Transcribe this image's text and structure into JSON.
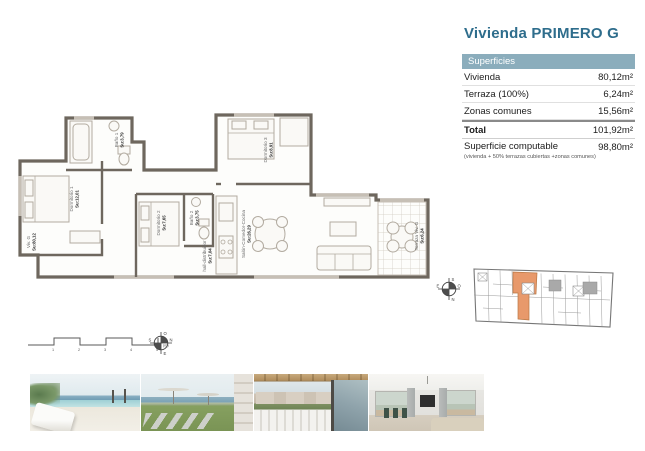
{
  "title": "Vivienda PRIMERO G",
  "surfaces": {
    "header": "Superficies",
    "rows": [
      {
        "label": "Vivienda",
        "value": "80,12m²"
      },
      {
        "label": "Terraza (100%)",
        "value": "6,24m²"
      },
      {
        "label": "Zonas comunes",
        "value": "15,56m²"
      }
    ],
    "total_label": "Total",
    "total_value": "101,92m²",
    "computable_label": "Superficie computable",
    "computable_note": "(vivienda + 50% terrazas cubiertas +zonas comunes)",
    "computable_value": "98,80m²"
  },
  "plan": {
    "unit_label": "Viv. G",
    "unit_area": "Su:80,12",
    "rooms": [
      {
        "name": "Dormitorio 1",
        "area": "Su:12,01"
      },
      {
        "name": "Baño 1",
        "area": "Su:3,79"
      },
      {
        "name": "Dormitorio 2",
        "area": "Su:7,65"
      },
      {
        "name": "Baño 2",
        "area": "Su:3,75"
      },
      {
        "name": "Dormitorio 3",
        "area": "Su:8,91"
      },
      {
        "name": "Salón-Comedor-Cocina",
        "area": "Su:26,29"
      },
      {
        "name": "hall-distribuidor",
        "area": "Su:7,04"
      },
      {
        "name": "Terraza Viv. G",
        "area": "Su:6,24"
      }
    ]
  },
  "scale_bar": {
    "ticks": [
      "1",
      "2",
      "3",
      "4",
      "5"
    ],
    "unit": "(m)"
  },
  "compass": {
    "north": "N",
    "south": "S",
    "east": "E",
    "west": "O"
  },
  "colors": {
    "accent_teal": "#2e6d8c",
    "table_header_bg": "#8badbc",
    "highlighted_unit": "#e8996b",
    "wall": "#6e675e"
  }
}
